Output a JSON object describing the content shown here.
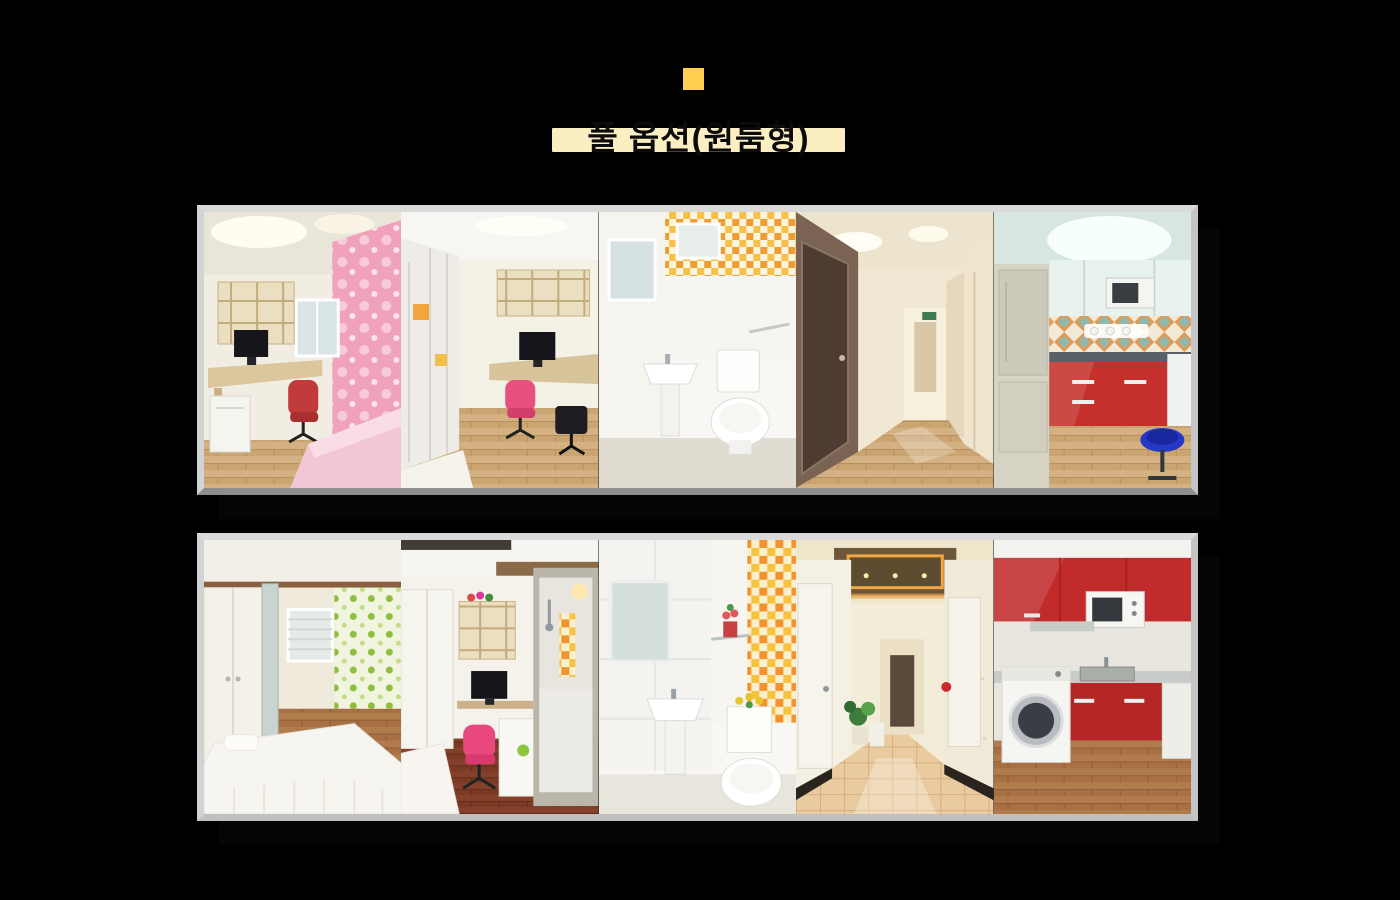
{
  "page": {
    "background_color": "#000000"
  },
  "header": {
    "accent_square_color": "#FFD04F",
    "title": "풀 옵션(원룸형)",
    "title_highlight_color": "#FBEEC3",
    "title_text_color": "#0B0B0B"
  },
  "galleries": [
    {
      "name": "row-1",
      "frame_color": "#D5D5D5",
      "photos": [
        {
          "name": "room-desk-pink-bed",
          "description": "Single room with built-in shelves, desk with computer monitor, red office chair, mini fridge, pink floral wallpaper and pink bed"
        },
        {
          "name": "room-wardrobe-desk",
          "description": "Single room with frosted wardrobe, wall shelf unit, desk with monitor, pink office chair, wooden floor and white bed"
        },
        {
          "name": "bathroom-yellow-tile",
          "description": "Bathroom with yellow-orange checker tiles, mirror, window, pedestal sink and toilet"
        },
        {
          "name": "hallway-wood-floor",
          "description": "Corridor with warm wooden floor, dark brown doors and ceiling lights"
        },
        {
          "name": "kitchen-red-cabinets",
          "description": "Shared kitchen with white upper cabinets, microwave, diamond tile backsplash, glossy red lower cabinets, refrigerator and blue stool"
        }
      ]
    },
    {
      "name": "row-2",
      "frame_color": "#D5D5D5",
      "photos": [
        {
          "name": "room-white-bed-green-wallpaper",
          "description": "Single room with white wardrobe, lace covered bed, green polka-dot wallpaper, window blinds and wooden floor"
        },
        {
          "name": "room-desk-shower-booth",
          "description": "Single room with shelf, desk with monitor, pink office chair, mini fridge and glass shower booth with orange tile strip"
        },
        {
          "name": "bathroom-orange-tile",
          "description": "Bathroom with white tiled wall, mirror, glass shelf with red flowers, orange checker tile column, pedestal sink and toilet with yellow flowers"
        },
        {
          "name": "hallway-glossy-tile",
          "description": "Corridor with glossy beige tile floor, white doors on both sides, plants and warm cove ceiling lighting"
        },
        {
          "name": "kitchen-red-washer",
          "description": "Shared kitchen with glossy red cabinets, microwave, stainless sink, front-load washing machine and wooden floor"
        }
      ]
    }
  ]
}
